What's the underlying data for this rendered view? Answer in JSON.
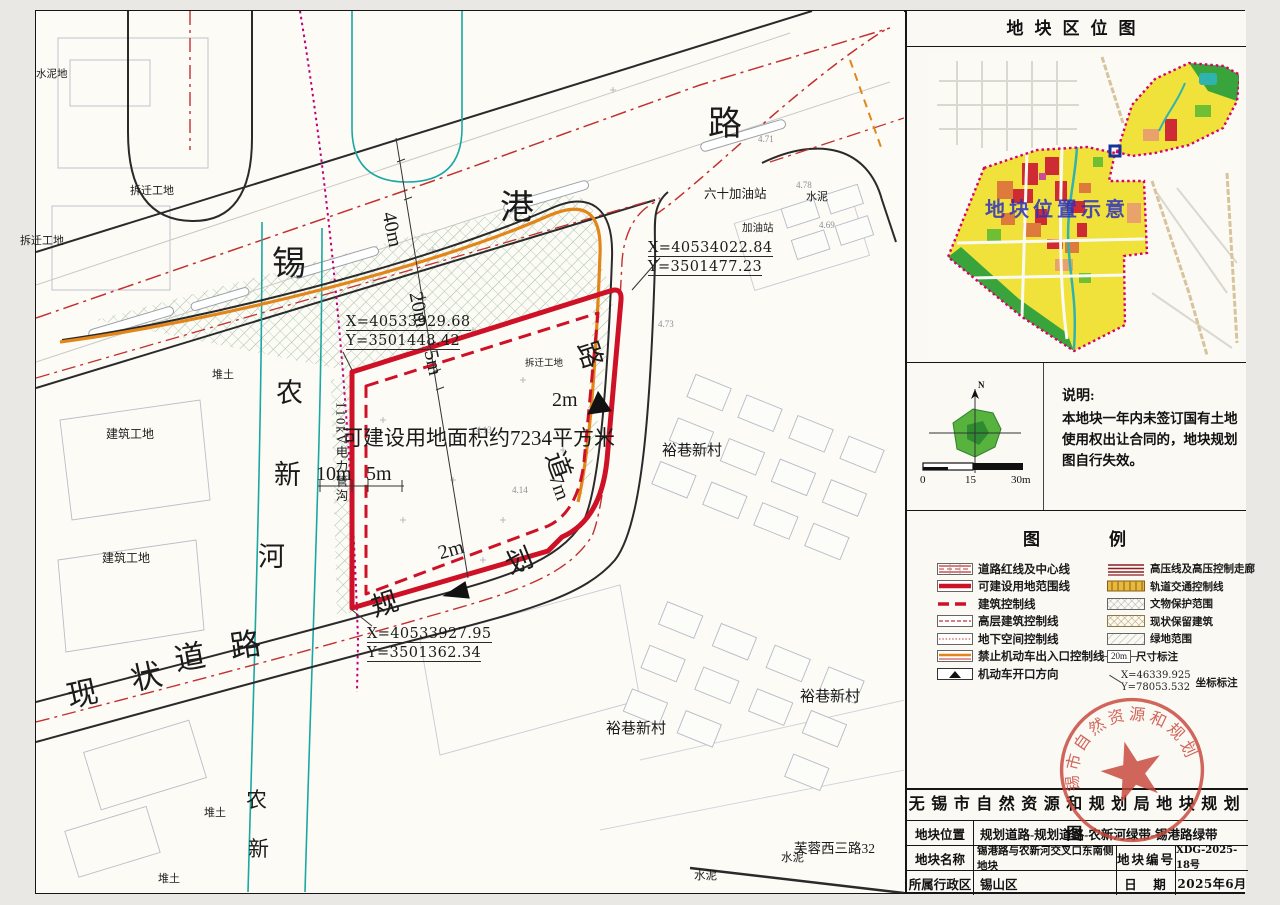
{
  "title_block": {
    "title": "无锡市自然资源和规划局地块规划图",
    "rows": [
      {
        "label": "地块位置",
        "value": "规划道路-规划道路-农新河绿带-锡港路绿带"
      },
      {
        "label": "地块名称",
        "value": "锡港路与农新河交叉口东南侧地块",
        "label2": "地块编号",
        "value2": "XDG-2025-18号"
      },
      {
        "label": "所属行政区",
        "value": "锡山区",
        "label2": "日　期",
        "value2": "2025年6月"
      }
    ]
  },
  "panel": {
    "location_title": "地块区位图",
    "location_hint": "地块位置示意",
    "note_title": "说明:",
    "note_body": "本地块一年内未签订国有土地使用权出让合同的，地块规划图自行失效。",
    "compass_n": "N",
    "scale_ticks": [
      "0",
      "15",
      "30m"
    ]
  },
  "legend": {
    "title": "图　例",
    "left": [
      "道路红线及中心线",
      "可建设用地范围线",
      "建筑控制线",
      "高层建筑控制线",
      "地下空间控制线",
      "禁止机动车出入口控制线",
      "机动车开口方向"
    ],
    "right": [
      "高压线及高压控制走廊",
      "轨道交通控制线",
      "文物保护范围",
      "现状保留建筑",
      "绿地范围",
      "尺寸标注",
      "坐标标注"
    ],
    "dim_sample": "20m",
    "coord_sample_x": "X=46339.925",
    "coord_sample_y": "Y=78053.532"
  },
  "stamp": {
    "text": "无锡市自然资源和规划局"
  },
  "map": {
    "labels": [
      {
        "t": "锡"
      },
      {
        "t": "港"
      },
      {
        "t": "路"
      },
      {
        "t": "农"
      },
      {
        "t": "新"
      },
      {
        "t": "河"
      },
      {
        "t": "现"
      },
      {
        "t": "状"
      },
      {
        "t": "道"
      },
      {
        "t": "路"
      },
      {
        "t": "规"
      },
      {
        "t": "划"
      },
      {
        "t": "道"
      },
      {
        "t": "路"
      },
      {
        "t": "农"
      },
      {
        "t": "新"
      },
      {
        "t": "可建设用地面积约7234平方米"
      },
      {
        "t": "40m"
      },
      {
        "t": "20m"
      },
      {
        "t": "5m"
      },
      {
        "t": "2m"
      },
      {
        "t": "7m"
      },
      {
        "t": "2m"
      },
      {
        "t": "10m"
      },
      {
        "t": "5m"
      },
      {
        "t": "110kV电力管沟"
      },
      {
        "t": "X=40533929.68"
      },
      {
        "t": "Y=3501448.42"
      },
      {
        "t": "X=40534022.84"
      },
      {
        "t": "Y=3501477.23"
      },
      {
        "t": "X=40533927.95"
      },
      {
        "t": "Y=3501362.34"
      },
      {
        "t": "六十加油站"
      },
      {
        "t": "水泥"
      },
      {
        "t": "拆迁工地"
      },
      {
        "t": "拆迁工地"
      },
      {
        "t": "拆迁工地"
      },
      {
        "t": "建筑工地"
      },
      {
        "t": "建筑工地"
      },
      {
        "t": "堆土"
      },
      {
        "t": "堆土"
      },
      {
        "t": "堆土"
      },
      {
        "t": "裕巷新村"
      },
      {
        "t": "裕巷新村"
      },
      {
        "t": "裕巷新村"
      },
      {
        "t": "芙蓉西三路32"
      },
      {
        "t": "水泥"
      },
      {
        "t": "水泥"
      },
      {
        "t": "水泥地"
      },
      {
        "t": "加油站"
      },
      {
        "t": "4.13"
      },
      {
        "t": "4.14"
      },
      {
        "t": "4.78"
      },
      {
        "t": "4.69"
      },
      {
        "t": "4.71"
      },
      {
        "t": "4.73"
      }
    ]
  },
  "colors": {
    "plot_red": "#ce1126",
    "control_orange": "#e2861a",
    "river_teal": "#1ba8a2",
    "boundary_magenta": "#c0007a",
    "stamp_red": "#c8473a",
    "zone_yellow": "#f0e23a",
    "zone_green": "#3aa43c"
  }
}
